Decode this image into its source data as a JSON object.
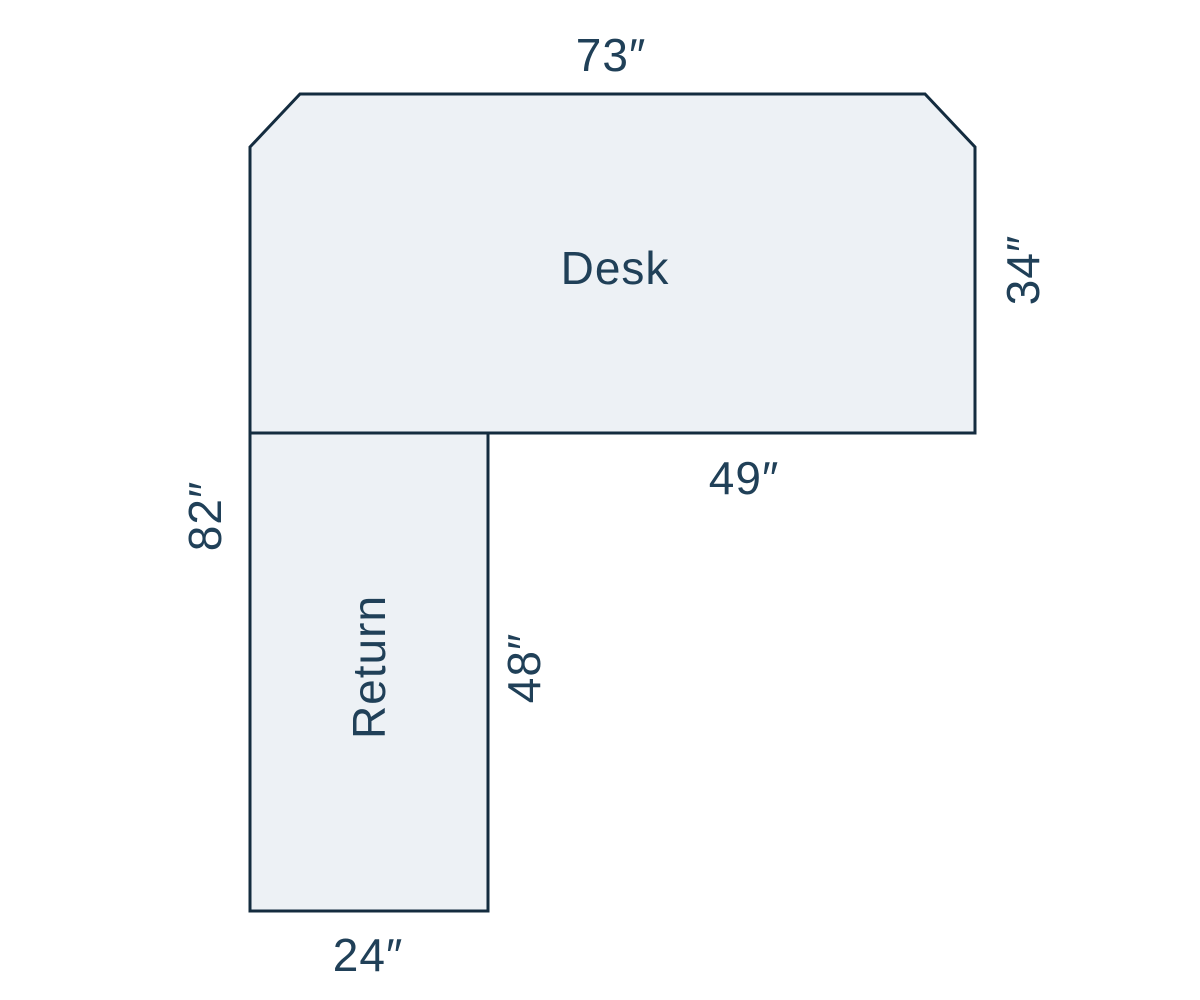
{
  "colors": {
    "background": "#ffffff",
    "shape_fill": "#edf1f5",
    "shape_stroke": "#142c3f",
    "label_text": "#204058"
  },
  "desk": {
    "label": "Desk",
    "top_width": "73″",
    "right_depth": "34″",
    "bottom_right_width": "49″"
  },
  "return": {
    "label": "Return",
    "overall_left_height": "82″",
    "right_height": "48″",
    "bottom_width": "24″"
  }
}
